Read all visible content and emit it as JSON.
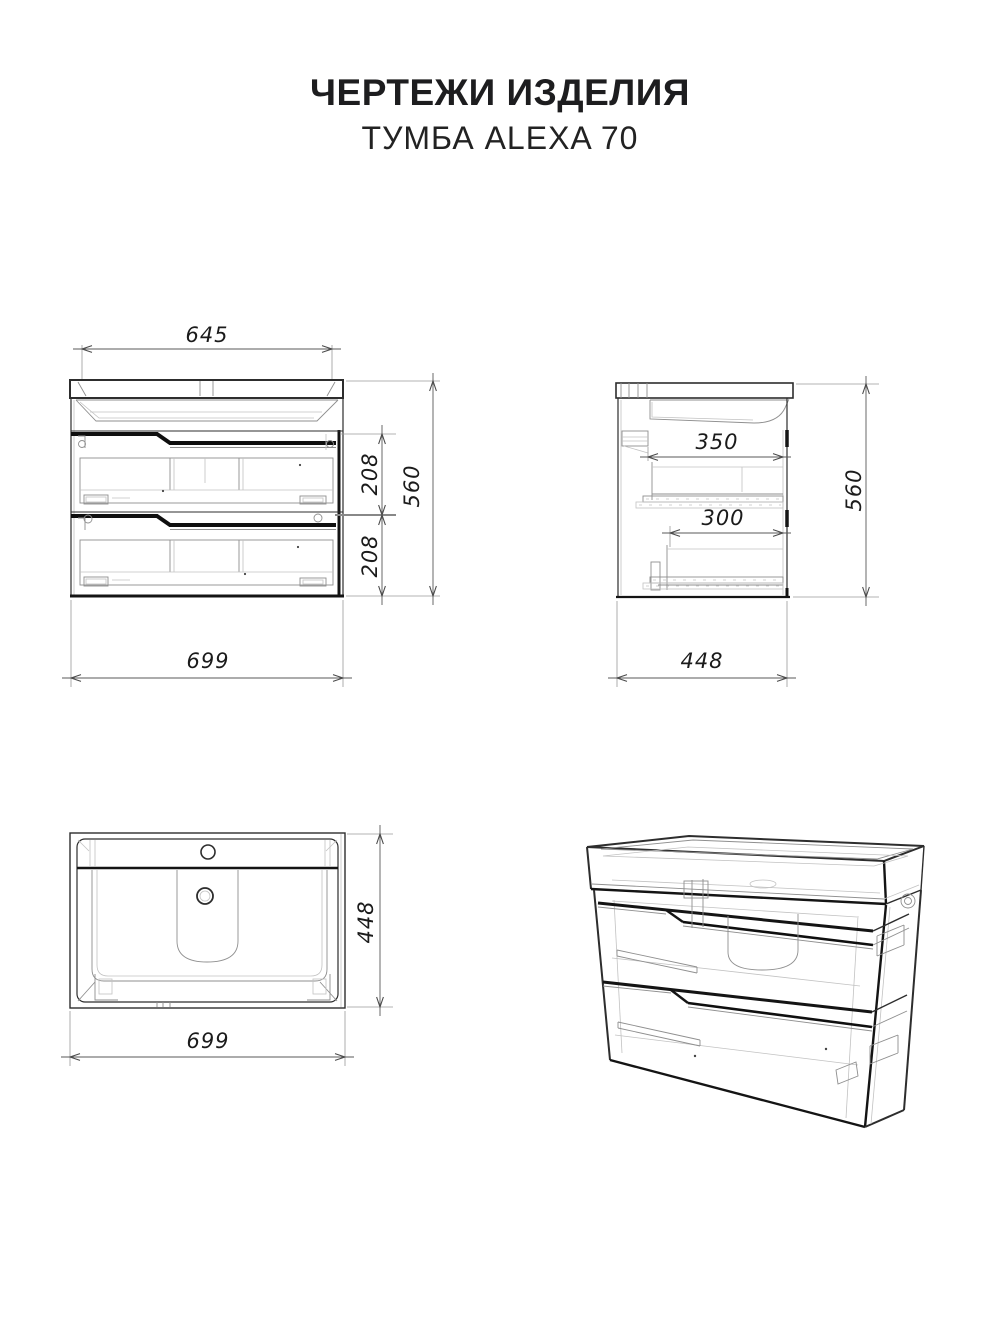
{
  "page": {
    "title": "ЧЕРТЕЖИ ИЗДЕЛИЯ",
    "subtitle": "ТУМБА ALEXA 70"
  },
  "front_view": {
    "dim_top_width": "645",
    "dim_drawer_top_height": "208",
    "dim_drawer_bottom_height": "208",
    "dim_total_height": "560",
    "dim_total_width": "699"
  },
  "side_view": {
    "dim_top_drawer_depth": "350",
    "dim_bottom_drawer_depth": "300",
    "dim_total_height": "560",
    "dim_total_depth": "448"
  },
  "top_view": {
    "dim_total_depth": "448",
    "dim_total_width": "699"
  },
  "colors": {
    "background": "#ffffff",
    "line_dark": "#141414",
    "line_light": "#8f8f8f",
    "dimension_text": "#1b1b1b"
  }
}
